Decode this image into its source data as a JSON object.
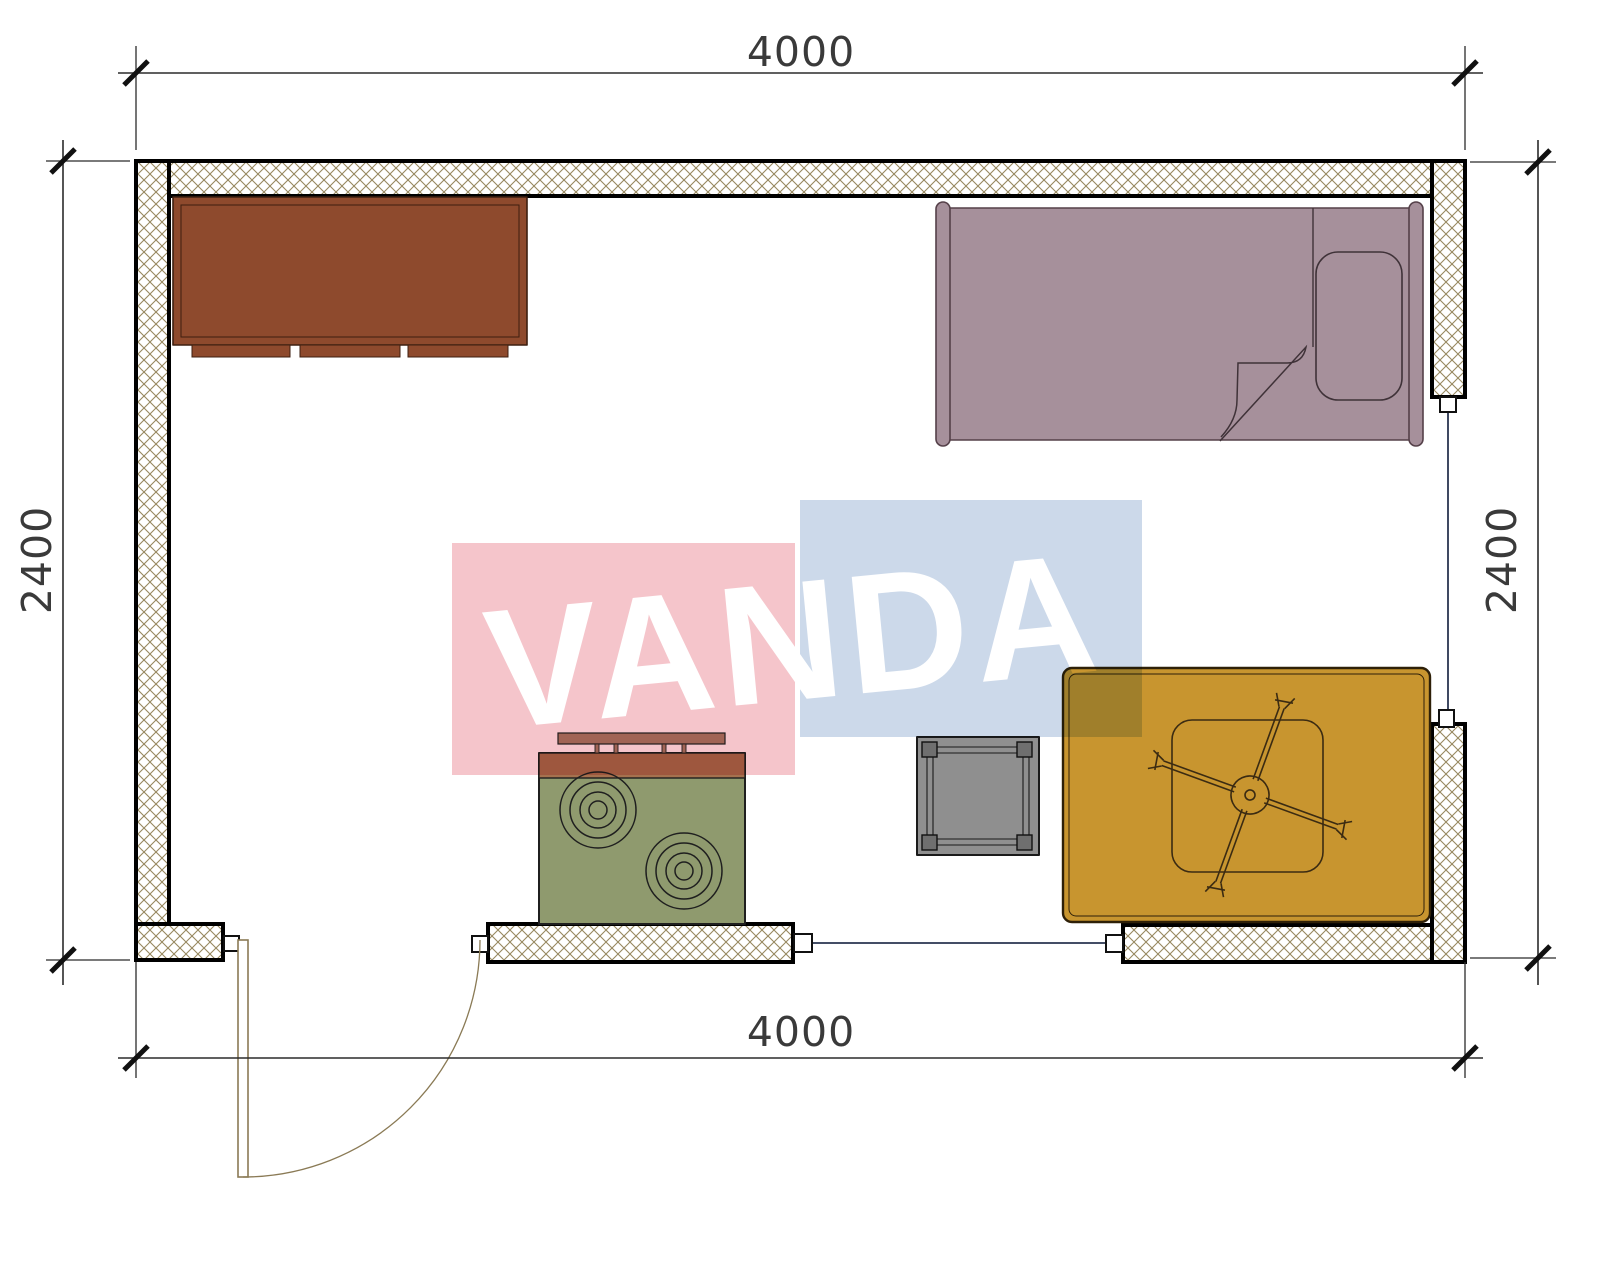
{
  "drawing": {
    "kind": "room-floor-plan",
    "dimensions": {
      "top": "4000",
      "bottom": "4000",
      "left": "2400",
      "right": "2400"
    },
    "watermark": {
      "text": "VANDA",
      "pink_color": "#f5c5cb",
      "blue_color": "#ccd9ea"
    },
    "colors": {
      "wall_hatch": "#97885f",
      "wall_border": "#000000",
      "cabinet": "#8e4a2d",
      "bed": "#a6909b",
      "stove_body": "#8f9a6e",
      "stove_top": "#a5714e",
      "shelf": "#a8816a",
      "side_table": "#8f8f8f",
      "side_table_leg": "#6f6f6f",
      "rug": "#c8952f",
      "door": "#8a7a55",
      "opening_line": "#2a3550",
      "dimension_text": "#3a3a3a",
      "fan_line": "#3b2b12"
    },
    "objects": [
      "cabinet",
      "single-bed",
      "pillow",
      "blanket-fold",
      "stove",
      "wall-shelf",
      "side-table",
      "rug",
      "ceiling-fan",
      "door"
    ]
  }
}
